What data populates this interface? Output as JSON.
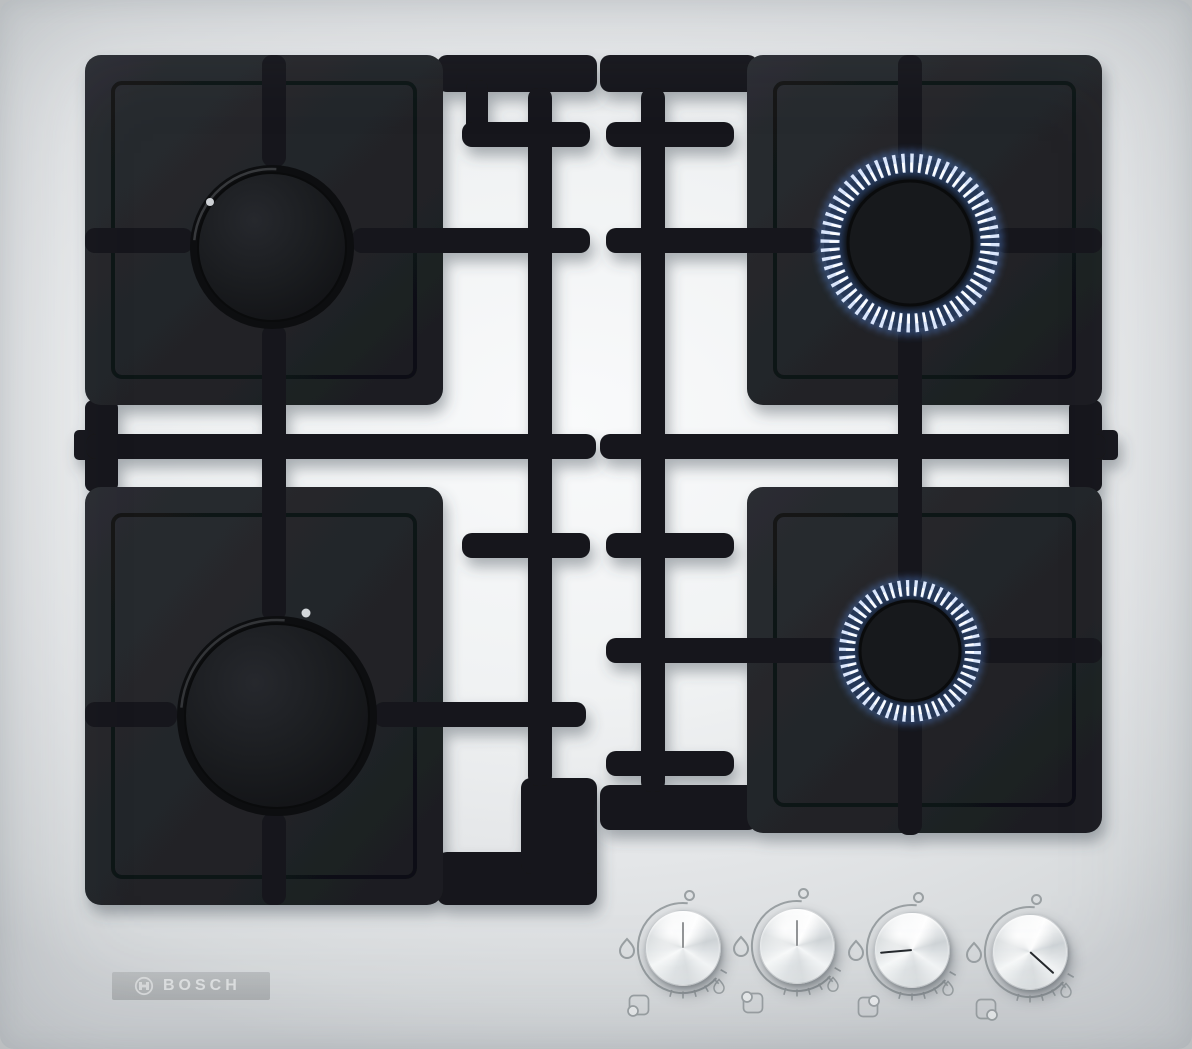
{
  "brand": {
    "name": "BOSCH",
    "symbol": "bosch-armature-icon"
  },
  "colors": {
    "surface": "#eef0f1",
    "grate_black": "#15171a",
    "plate_black": "#222428",
    "flame_core": "#ffffff",
    "flame_blue": "#4d7ac8",
    "knob_metal": "#e9ebed",
    "marking_gray": "#9aa0a3",
    "logo_bar": "#b4b7b9"
  },
  "burners": [
    {
      "id": "back-left",
      "state": "off",
      "flame_level": "none",
      "relative_size": "medium"
    },
    {
      "id": "front-left",
      "state": "off",
      "flame_level": "none",
      "relative_size": "large"
    },
    {
      "id": "back-right",
      "state": "lit",
      "flame_level": "high",
      "relative_size": "medium"
    },
    {
      "id": "front-right",
      "state": "lit",
      "flame_level": "low",
      "relative_size": "small"
    }
  ],
  "knobs": [
    {
      "id": "knob-front-left",
      "controls": "front-left",
      "state": "off",
      "position_icon": "hob-position-front-left-icon",
      "pointer_style": "transform: rotate(180deg); background: rgba(42,46,50,0.5); height: 26px"
    },
    {
      "id": "knob-back-left",
      "controls": "back-left",
      "state": "off",
      "position_icon": "hob-position-back-left-icon",
      "pointer_style": "transform: rotate(180deg); background: rgba(42,46,50,0.5); height: 26px"
    },
    {
      "id": "knob-back-right",
      "controls": "back-right",
      "state": "high",
      "position_icon": "hob-position-back-right-icon",
      "pointer_style": "transform: rotate(85deg); background: #24272b"
    },
    {
      "id": "knob-front-right",
      "controls": "front-right",
      "state": "low",
      "position_icon": "hob-position-front-right-icon",
      "pointer_style": "transform: rotate(-48deg); background: #24272b"
    }
  ],
  "knob_markings": {
    "off_icon": "off-position-circle",
    "high_icon": "flame-high-icon",
    "low_icon": "flame-low-icon"
  }
}
